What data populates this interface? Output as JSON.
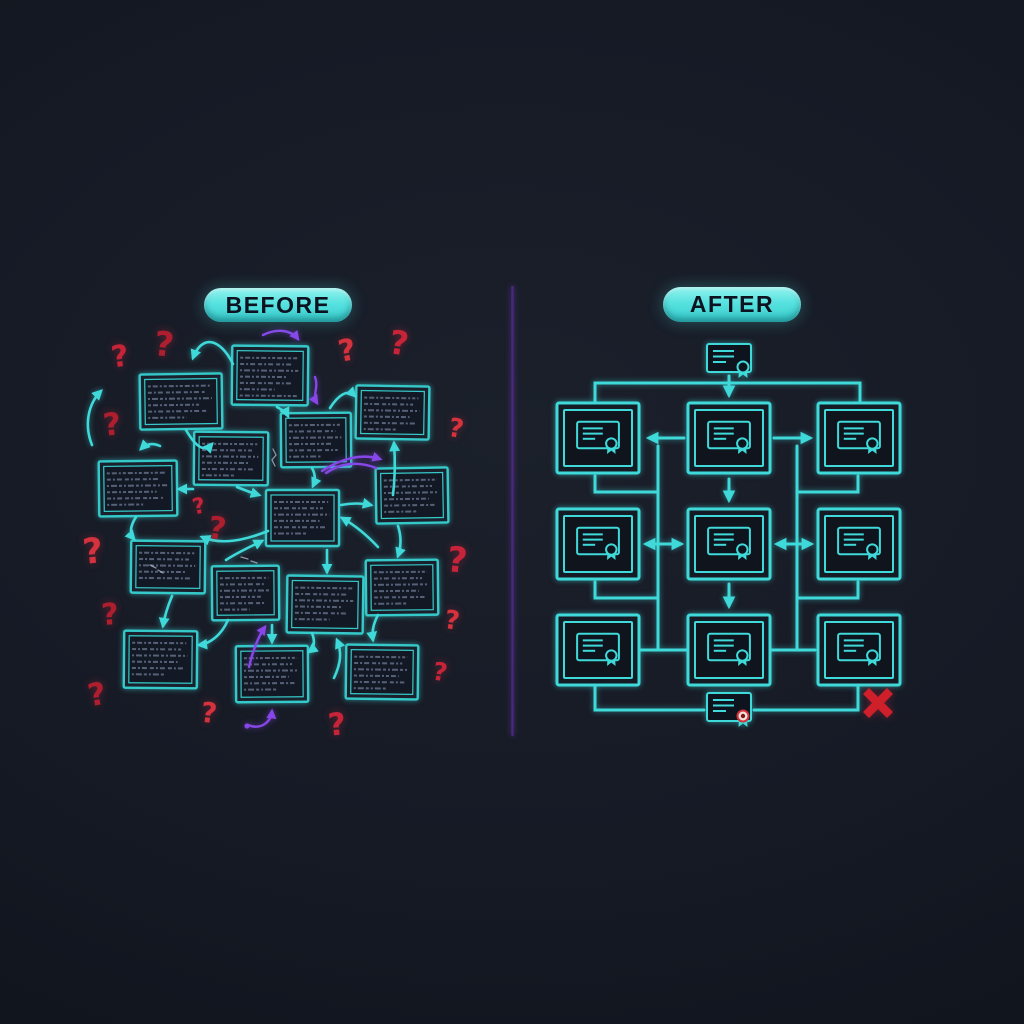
{
  "colors": {
    "cyan": "#3fd9d9",
    "cyan_dim": "#35c9c9",
    "purple": "#8747e8",
    "divider_purple": "#4b2a80",
    "red": "#c7243a",
    "red_bright": "#d4323c",
    "scribble": "#5c6880",
    "white_mark": "#cdd4e8"
  },
  "divider": {
    "x": 512.5,
    "y1": 287,
    "y2": 735
  },
  "before_panel": {
    "label": "BEFORE",
    "box_text_style": "illegible-scribble",
    "boxes": [
      [
        140,
        374,
        82,
        55,
        -0.8
      ],
      [
        232,
        346,
        76,
        59,
        0.6
      ],
      [
        281,
        413,
        70,
        54,
        -0.5
      ],
      [
        356,
        386,
        73,
        53,
        0.9
      ],
      [
        99,
        461,
        78,
        55,
        -0.7
      ],
      [
        194,
        432,
        74,
        53,
        0.5
      ],
      [
        266,
        490,
        73,
        56,
        0.0
      ],
      [
        376,
        468,
        72,
        55,
        -0.9
      ],
      [
        131,
        541,
        74,
        52,
        0.6
      ],
      [
        212,
        566,
        67,
        54,
        -0.5
      ],
      [
        287,
        576,
        76,
        57,
        0.8
      ],
      [
        366,
        560,
        72,
        55,
        -0.6
      ],
      [
        124,
        631,
        73,
        57,
        0.5
      ],
      [
        236,
        646,
        72,
        56,
        -0.4
      ],
      [
        346,
        645,
        72,
        54,
        0.7
      ]
    ],
    "arrows": [
      [
        "M 233 364 C 220 338 202 334 193 358",
        "end"
      ],
      [
        "M 186 430 C 197 449 205 452 212 444",
        "end"
      ],
      [
        "M 277 407 Q 286 412 288 416",
        "end"
      ],
      [
        "M 330 408 C 339 394 348 389 355 396",
        "end"
      ],
      [
        "M 312 468 Q 317 477 313 486",
        "end"
      ],
      [
        "M 237 487 Q 249 492 259 495",
        "end"
      ],
      [
        "M 193 489 L 179 489",
        "end"
      ],
      [
        "M 160 446 Q 149 441 141 449",
        "end"
      ],
      [
        "M 136 517 Q 127 531 134 539",
        "end"
      ],
      [
        "M 268 531 C 243 541 221 545 202 537",
        "end"
      ],
      [
        "M 226 560 C 240 551 252 546 262 541",
        "end"
      ],
      [
        "M 341 505 Q 357 502 371 505",
        "end"
      ],
      [
        "M 393 495 Q 396 470 394 443",
        "end"
      ],
      [
        "M 378 547 C 363 531 351 523 342 518",
        "end"
      ],
      [
        "M 327 550 L 327 572",
        "end"
      ],
      [
        "M 398 526 Q 403 541 398 556",
        "end"
      ],
      [
        "M 228 620 C 221 636 209 644 199 645",
        "end"
      ],
      [
        "M 272 625 L 272 642",
        "end"
      ],
      [
        "M 312 633 Q 317 646 309 652",
        "end"
      ],
      [
        "M 334 678 C 341 663 342 652 337 640",
        "end"
      ],
      [
        "M 378 615 Q 371 628 373 640",
        "end"
      ],
      [
        "M 172 596 Q 165 613 163 626",
        "end"
      ],
      [
        "M 92 445 C 84 425 88 404 101 391",
        "end"
      ]
    ],
    "purple_arrows": [
      [
        "M 263 335 C 277 328 291 330 298 339",
        "end"
      ],
      [
        "M 315 377 C 319 387 312 395 317 403",
        "end"
      ],
      [
        "M 322 471 C 340 459 361 453 380 459",
        "end"
      ],
      [
        "M 376 468 C 358 461 340 463 326 473",
        "none"
      ],
      [
        "M 249 667 C 253 650 258 637 265 627",
        "end"
      ],
      [
        "M 248 725 C 260 730 271 723 272 711",
        "end"
      ]
    ],
    "purple_dots": [
      [
        247,
        726
      ]
    ],
    "white_marks": [
      "M 273 449 l 3 6 -4 5 3 6",
      "M 241 557 l 7 2 m 3 2 l 6 2",
      "M 150 565 l 6 3 m 2 2 l 5 3"
    ],
    "question_marks": [
      [
        120,
        357,
        30,
        -8
      ],
      [
        164,
        345,
        34,
        6
      ],
      [
        347,
        351,
        30,
        -10
      ],
      [
        399,
        343,
        33,
        8
      ],
      [
        112,
        425,
        31,
        -5
      ],
      [
        456,
        429,
        26,
        10
      ],
      [
        199,
        507,
        22,
        -12
      ],
      [
        217,
        529,
        31,
        8
      ],
      [
        93,
        552,
        35,
        -6
      ],
      [
        457,
        561,
        35,
        6
      ],
      [
        110,
        615,
        30,
        -4
      ],
      [
        452,
        621,
        26,
        8
      ],
      [
        440,
        672,
        25,
        10
      ],
      [
        97,
        695,
        31,
        -10
      ],
      [
        209,
        713,
        28,
        6
      ],
      [
        337,
        725,
        31,
        -5
      ]
    ],
    "question_mark_glyph": "?"
  },
  "after_panel": {
    "label": "AFTER",
    "grid": {
      "column_lefts": [
        557,
        688,
        818
      ],
      "row_tops": [
        403,
        509,
        615
      ],
      "box_w": 82,
      "box_h": 70
    },
    "top_certificate": {
      "cx": 729,
      "cy": 358,
      "scale": 1.0,
      "seal": "cyan"
    },
    "bottom_certificate": {
      "cx": 729,
      "cy": 707,
      "scale": 1.0,
      "seal": "red"
    },
    "connectors": [
      "M 595 402 L 595 383 L 860 383 L 860 402",
      "M 658 446 L 658 648",
      "M 797 446 L 797 648",
      "M 595 476 L 595 492 L 658 492",
      "M 858 476 L 858 492 L 797 492",
      "M 595 582 L 595 598 L 658 598",
      "M 858 582 L 858 598 L 797 598",
      "M 641 650 L 686 650",
      "M 771 650 L 815 650",
      "M 595 687 L 595 710 L 704 710",
      "M 754 710 L 858 710 L 858 687"
    ],
    "arrows": [
      [
        "M 729 376 L 729 395",
        "end"
      ],
      [
        "M 684 438 L 649 438",
        "end"
      ],
      [
        "M 774 438 L 810 438",
        "end"
      ],
      [
        "M 729 479 L 729 500",
        "end"
      ],
      [
        "M 646 544 L 681 544",
        "both"
      ],
      [
        "M 777 544 L 811 544",
        "both"
      ],
      [
        "M 729 584 L 729 606",
        "end"
      ]
    ],
    "red_x": {
      "lines": [
        [
          866,
          691,
          890,
          715
        ],
        [
          890,
          691,
          866,
          715
        ]
      ],
      "stroke_width": 8.5
    }
  }
}
